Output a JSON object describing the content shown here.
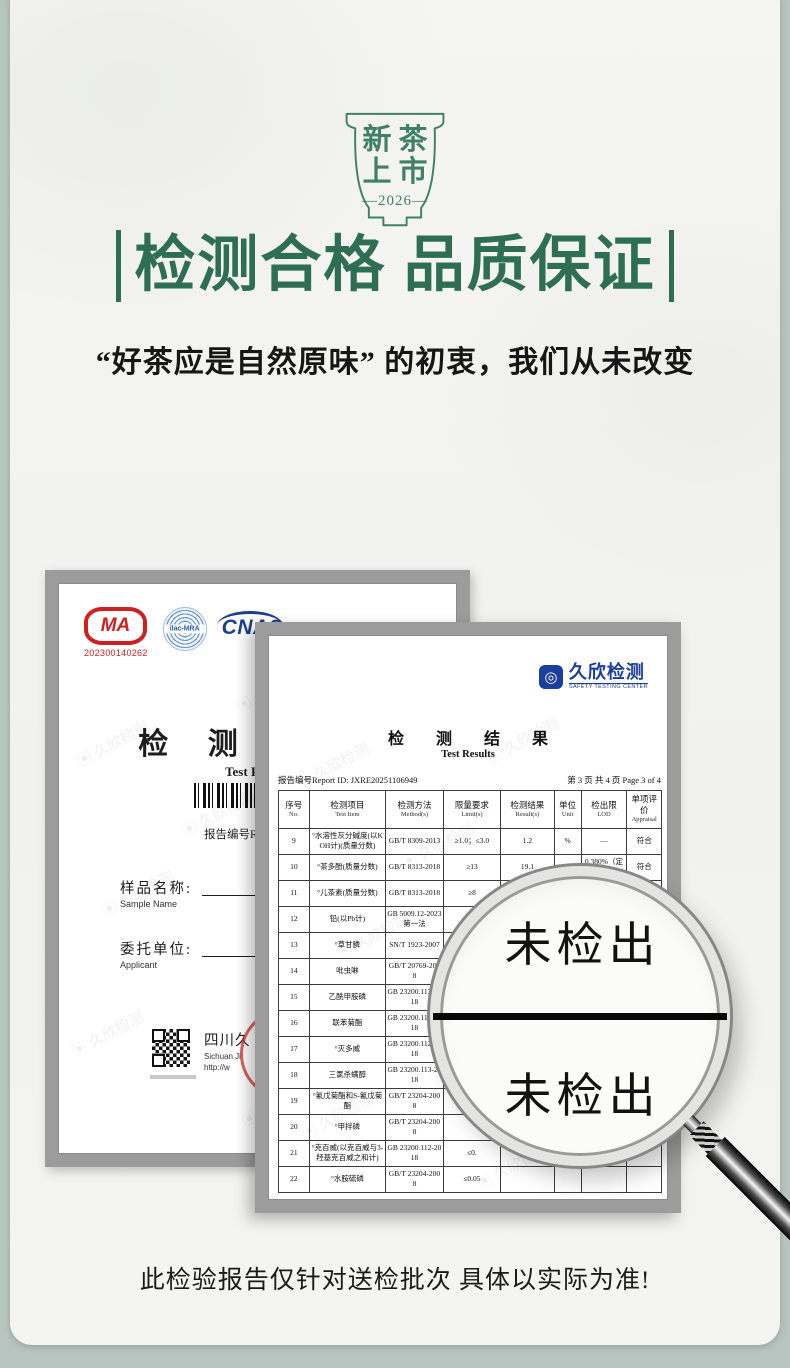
{
  "badge": {
    "row1": "新茶",
    "row2": "上市",
    "year": "—2026—"
  },
  "hero": {
    "title": "检测合格 品质保证",
    "subtitle": "“好茶应是自然原味” 的初衷，我们从未改变"
  },
  "cert_left": {
    "cma_label": "MA",
    "cma_number": "202300140262",
    "ilac_label": "ilac-MRA",
    "cnas_label": "CNAS",
    "title": "检 测 报 告",
    "title_en": "Test Report",
    "report_no": "报告编号Report",
    "sample_label": "样品名称:",
    "sample_label_en": "Sample Name",
    "applicant_label": "委托单位:",
    "applicant_label_en": "Applicant",
    "company": "四川久",
    "company_en": "Sichuan Ji",
    "company_url": "http://w"
  },
  "cert_right": {
    "logo": "久欣检测",
    "logo_sub": "SAFETY TESTING CENTER",
    "title": "检 测 结 果",
    "title_en": "Test Results",
    "report_id": "报告编号Report ID: JXRE20251106949",
    "page_info": "第 3 页 共 4 页 Page 3 of 4",
    "table": {
      "headers": [
        {
          "cn": "序号",
          "en": "No."
        },
        {
          "cn": "检测项目",
          "en": "Test Item"
        },
        {
          "cn": "检测方法",
          "en": "Method(s)"
        },
        {
          "cn": "限量要求",
          "en": "Limit(s)"
        },
        {
          "cn": "检测结果",
          "en": "Result(s)"
        },
        {
          "cn": "单位",
          "en": "Unit"
        },
        {
          "cn": "检出限",
          "en": "LOD"
        },
        {
          "cn": "单项评价",
          "en": "Appraisal"
        }
      ],
      "rows": [
        [
          "9",
          "°水溶性灰分碱度(以KOH计)(质量分数)",
          "GB/T 8309-2013",
          "≥1.0；≤3.0",
          "1.2",
          "%",
          "—",
          "符合"
        ],
        [
          "10",
          "°茶多酚(质量分数)",
          "GB/T 8313-2018",
          "≥13",
          "19.1",
          "%",
          "0.380%（定量限）",
          "符合"
        ],
        [
          "11",
          "°儿茶素(质量分数)",
          "GB/T 8313-2018",
          "≥8",
          "14.72",
          "%",
          "0.0125g/100g（定量限）",
          "符合"
        ],
        [
          "12",
          "铅(以Pb计)",
          "GB 5009.12-2023 第一法",
          "≤5.0",
          "",
          "",
          "",
          ""
        ],
        [
          "13",
          "°草甘膦",
          "SN/T 1923-2007",
          "≤1",
          "",
          "",
          "",
          ""
        ],
        [
          "14",
          "吡虫啉",
          "GB/T 20769-2008",
          "",
          "",
          "",
          "",
          ""
        ],
        [
          "15",
          "乙酰甲胺磷",
          "GB 23200.113-2018",
          "",
          "",
          "",
          "",
          ""
        ],
        [
          "16",
          "联苯菊酯",
          "GB 23200.113-2018",
          "",
          "",
          "",
          "",
          ""
        ],
        [
          "17",
          "°灭多威",
          "GB 23200.112-2018",
          "",
          "",
          "",
          "",
          ""
        ],
        [
          "18",
          "三氯杀螨醇",
          "GB 23200.113-2018",
          "",
          "",
          "",
          "",
          ""
        ],
        [
          "19",
          "°氰戊菊酯和S-氰戊菊酯",
          "GB/T 23204-2008",
          "",
          "",
          "",
          "",
          ""
        ],
        [
          "20",
          "°甲拌磷",
          "GB/T 23204-2008",
          "",
          "",
          "",
          "",
          ""
        ],
        [
          "21",
          "°克百威(以克百威与3-羟基克百威之和计)",
          "GB 23200.112-2018",
          "≤0.",
          "",
          "",
          "",
          ""
        ],
        [
          "22",
          "°水胺硫磷",
          "GB/T 23204-2008",
          "≤0.05",
          "",
          "",
          "",
          ""
        ]
      ]
    }
  },
  "magnifier": {
    "top": "未检出",
    "bottom": "未检出"
  },
  "watermark": {
    "text": "▣ 久欣检测"
  },
  "footer": {
    "note": "此检验报告仅针对送检批次 具体以实际为准!"
  },
  "colors": {
    "green": "#2e6e53",
    "badge_green": "#3f8066",
    "red": "#cf1f1f",
    "blue": "#1c3f9e",
    "frame": "#9c9c9c"
  }
}
